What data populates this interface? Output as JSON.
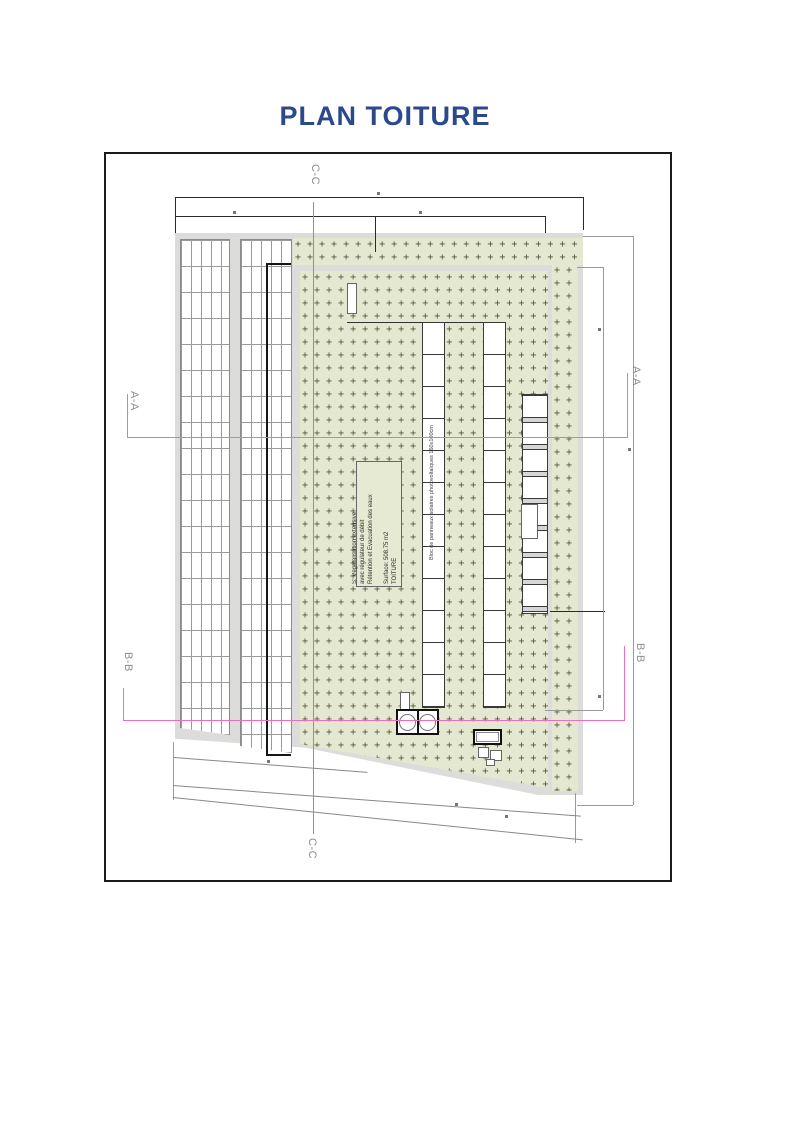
{
  "document": {
    "title": "PLAN TOITURE"
  },
  "sections": {
    "aa": "A-A",
    "bb": "B-B",
    "cc": "C-C"
  },
  "roof_note": {
    "line1": "TOITURE",
    "line2": "Surface: 508.75 m2",
    "line3": "Rétention et Evacuation des eaux",
    "line4": "avec régulateur de débit",
    "line5": "S: Végétalisation extensive"
  },
  "labels": {
    "solar_block": "Bloc de panneaux solaires photovoltaïques 160x100cm"
  },
  "colors": {
    "title_blue": "#2B4A8C",
    "section_pink": "#F06CBE",
    "section_violet": "#C06CD0",
    "green_roof": "#E5E8D1",
    "plus_mark": "#55553B",
    "edge_gray": "#DCDCDB"
  }
}
